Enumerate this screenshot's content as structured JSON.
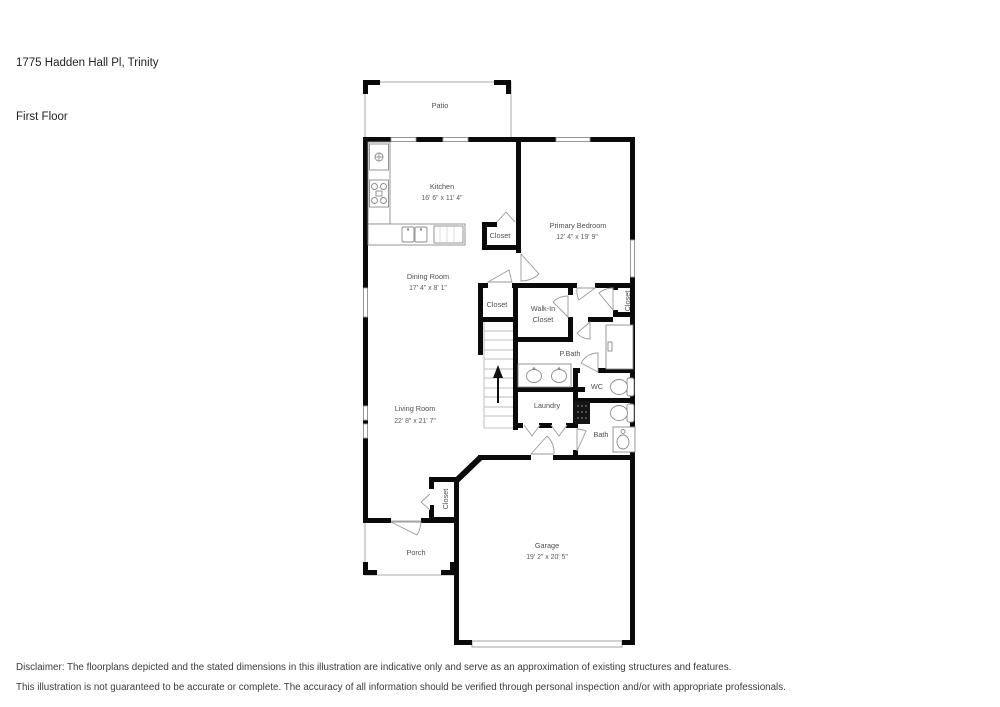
{
  "header": {
    "address": "1775 Hadden Hall Pl, Trinity",
    "floor": "First Floor"
  },
  "rooms": {
    "patio": {
      "label": "Patio"
    },
    "kitchen": {
      "label": "Kitchen",
      "dims": "16' 6\" x 11' 4\""
    },
    "primary_bedroom": {
      "label": "Primary Bedroom",
      "dims": "12' 4\" x 19' 9\""
    },
    "dining_room": {
      "label": "Dining Room",
      "dims": "17' 4\" x 8' 1\""
    },
    "living_room": {
      "label": "Living Room",
      "dims": "22' 8\" x 21' 7\""
    },
    "garage": {
      "label": "Garage",
      "dims": "19' 2\" x 20' 5\""
    },
    "porch": {
      "label": "Porch"
    },
    "laundry": {
      "label": "Laundry"
    },
    "primary_bath": {
      "label": "P.Bath"
    },
    "wc": {
      "label": "WC"
    },
    "bath": {
      "label": "Bath"
    },
    "walk_in_closet": {
      "line1": "Walk-In",
      "line2": "Closet"
    },
    "closet_kitchen": {
      "label": "Closet"
    },
    "closet_hall": {
      "label": "Closet"
    },
    "closet_bedroom": {
      "label": "Closet"
    },
    "closet_entry": {
      "label": "Closet"
    }
  },
  "disclaimer": {
    "line1": "Disclaimer: The floorplans depicted and the stated dimensions in this illustration are indicative only and serve as an approximation of existing structures and features.",
    "line2": "This illustration is not guaranteed to be accurate or complete. The accuracy of all information should be verified through personal inspection and/or with appropriate professionals."
  },
  "colors": {
    "wall": "#0a0a0a",
    "thin_line": "#aaaaaa",
    "label_text": "#4f4f4f",
    "background": "#ffffff"
  }
}
